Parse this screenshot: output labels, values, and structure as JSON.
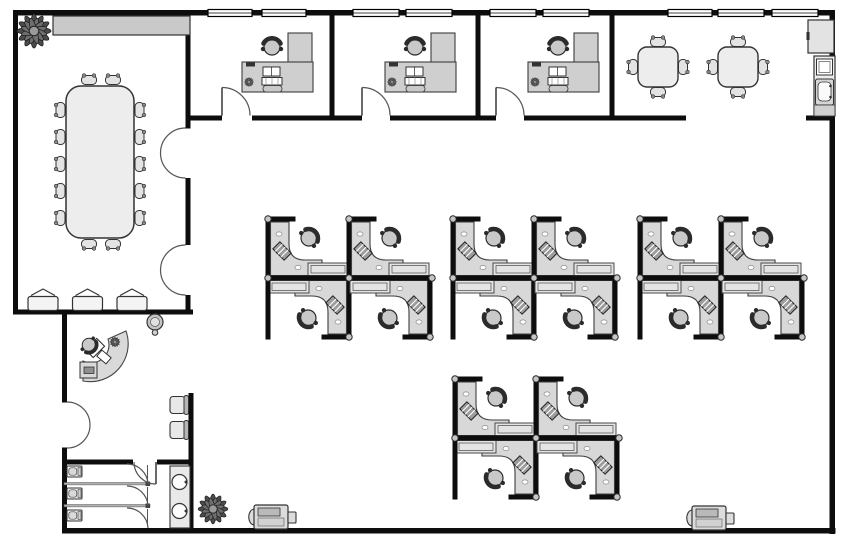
{
  "meta": {
    "diagram_type": "office-floor-plan"
  },
  "colors": {
    "wall": "#0d0d0d",
    "floor": "#ffffff",
    "partition": "#0d0d0d",
    "desk_fill": "#d8d8d8",
    "office_desk_fill": "#cfcfcf",
    "side_table_fill": "#e4e4e4",
    "credenza_fill": "#c9c9c9",
    "table_fill": "#ededed",
    "chair_fill": "#e3e3e3",
    "post_fill": "#c6c6c6",
    "plant_color": "#4a4a4a",
    "counter_fill": "#ededed",
    "appliance_fill": "#e3e3e3",
    "printer_fill": "#dcdcdc"
  },
  "rooms": {
    "conference_room": {
      "table_seats": 14,
      "stacking_chairs": 3,
      "credenza": 1,
      "plants": 1,
      "double_door_openings": 2
    },
    "private_offices": {
      "count": 3,
      "per_office": {
        "l_shaped_desk": 1,
        "task_chair": 1,
        "computer": 1,
        "desk_plant": 1,
        "phone": 1,
        "door": 1,
        "windows": 2
      }
    },
    "break_room": {
      "square_tables": 2,
      "chairs_per_table": 4,
      "refrigerator": 1,
      "microwave": 1,
      "sink": 1,
      "windows": 3
    },
    "open_office": {
      "cubicle_clusters": 4,
      "cubicles_per_cluster": 4,
      "total_workstations": 16
    },
    "reception": {
      "curved_desk": 1,
      "task_chair": 1,
      "waiting_chairs": 2,
      "water_cooler": 1,
      "entrance_double_door": 1
    },
    "restroom": {
      "stalls": 3,
      "toilets": 3,
      "sinks": 2,
      "door": 1
    }
  },
  "shared_items": {
    "printers": 2,
    "floor_plants": 2,
    "window_segments": 9
  }
}
